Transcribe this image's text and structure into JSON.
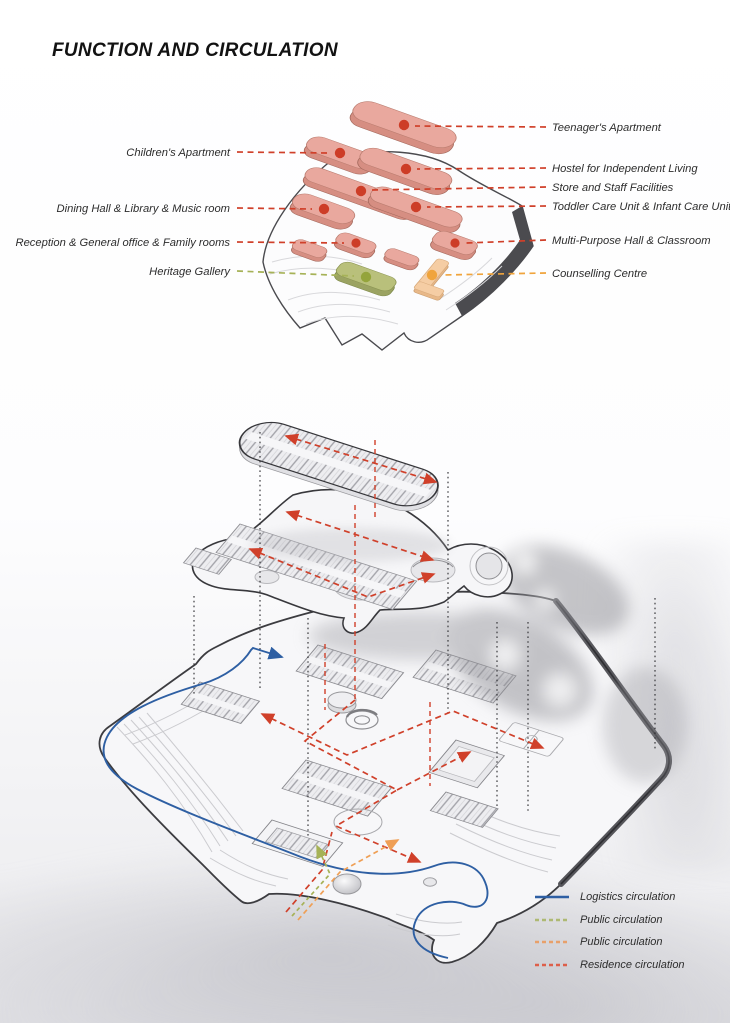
{
  "title": "FUNCTION AND CIRCULATION",
  "upper_diagram": {
    "labels_left": [
      {
        "text": "Children's Apartment",
        "color": "#d0402a",
        "dot": "#cd3d27"
      },
      {
        "text": "Dining Hall & Library & Music room",
        "color": "#d0402a",
        "dot": "#cd3d27"
      },
      {
        "text": "Reception & General office & Family rooms",
        "color": "#d0402a",
        "dot": "#cd3d27"
      },
      {
        "text": "Heritage Gallery",
        "color": "#a6b257",
        "dot": "#94a43c"
      }
    ],
    "labels_right": [
      {
        "text": "Teenager's  Apartment",
        "color": "#d0402a",
        "dot": "#cd3d27"
      },
      {
        "text": "Hostel for Independent Living",
        "color": "#d0402a",
        "dot": "#cd3d27"
      },
      {
        "text": "Store and Staff Facilities",
        "color": "#d0402a",
        "dot": "#cd3d27"
      },
      {
        "text": "Toddler Care Unit & Infant Care Unit",
        "color": "#d0402a",
        "dot": "#cd3d27"
      },
      {
        "text": "Multi-Purpose Hall & Classroom",
        "color": "#d0402a",
        "dot": "#cd3d27"
      },
      {
        "text": "Counselling Centre",
        "color": "#f0a43c",
        "dot": "#f0a43c"
      }
    ]
  },
  "legend": {
    "items": [
      {
        "label": "Logistics circulation",
        "color": "#2e5fa3",
        "style": "solid"
      },
      {
        "label": "Public circulation",
        "color": "#aeb973",
        "style": "dashed"
      },
      {
        "label": "Public circulation",
        "color": "#e8a06a",
        "style": "dashed"
      },
      {
        "label": "Residence circulation",
        "color": "#dd5f4a",
        "style": "dashed"
      }
    ]
  },
  "colors": {
    "residence_block_top": "#e9a89e",
    "residence_block_side": "#d68e82",
    "heritage_block_top": "#b9c07b",
    "heritage_block_side": "#9ba362",
    "counselling_block_top": "#f5cda4",
    "counselling_block_side": "#e8b888",
    "logistics_blue": "#2e5fa3",
    "residence_red": "#d0402a",
    "public_green": "#a6b257",
    "public_orange": "#ef9f55"
  }
}
